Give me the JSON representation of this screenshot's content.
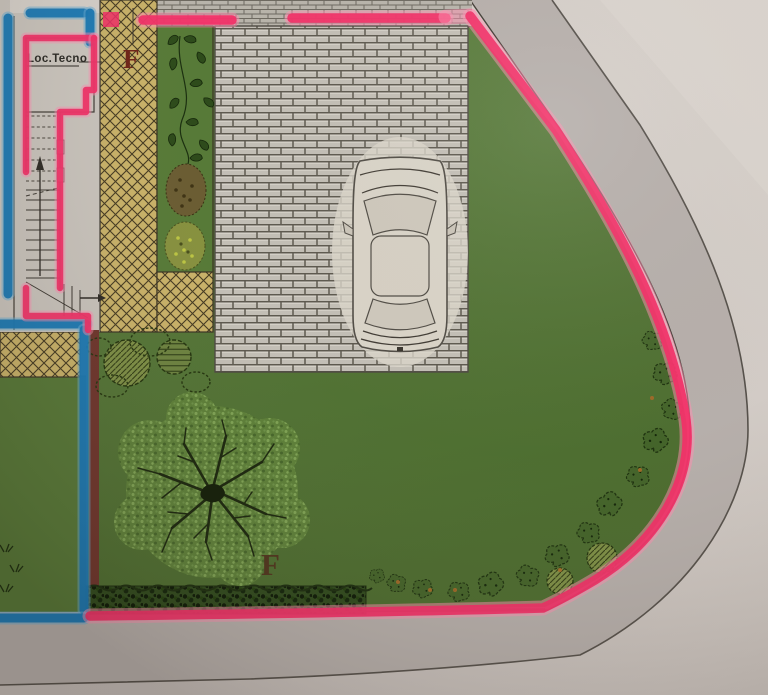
{
  "plan": {
    "room_label": "Loc.Tecno",
    "zone_markers": {
      "top": "F",
      "bottom": "F"
    },
    "colors": {
      "boundary_highlight": "#F22F67",
      "boundary_fringe": "#FF8FB2",
      "wall_highlight": "#1777B4",
      "wall_fringe": "#66ABD4",
      "lawn": "#567837",
      "terrace": "#C9B269",
      "paving": "#C3BFB6",
      "sidewalk": "#B6AFAB",
      "road": "#D1CBC6",
      "annotation_red": "#6F2418",
      "maroon_wall": "#6E352C"
    }
  }
}
